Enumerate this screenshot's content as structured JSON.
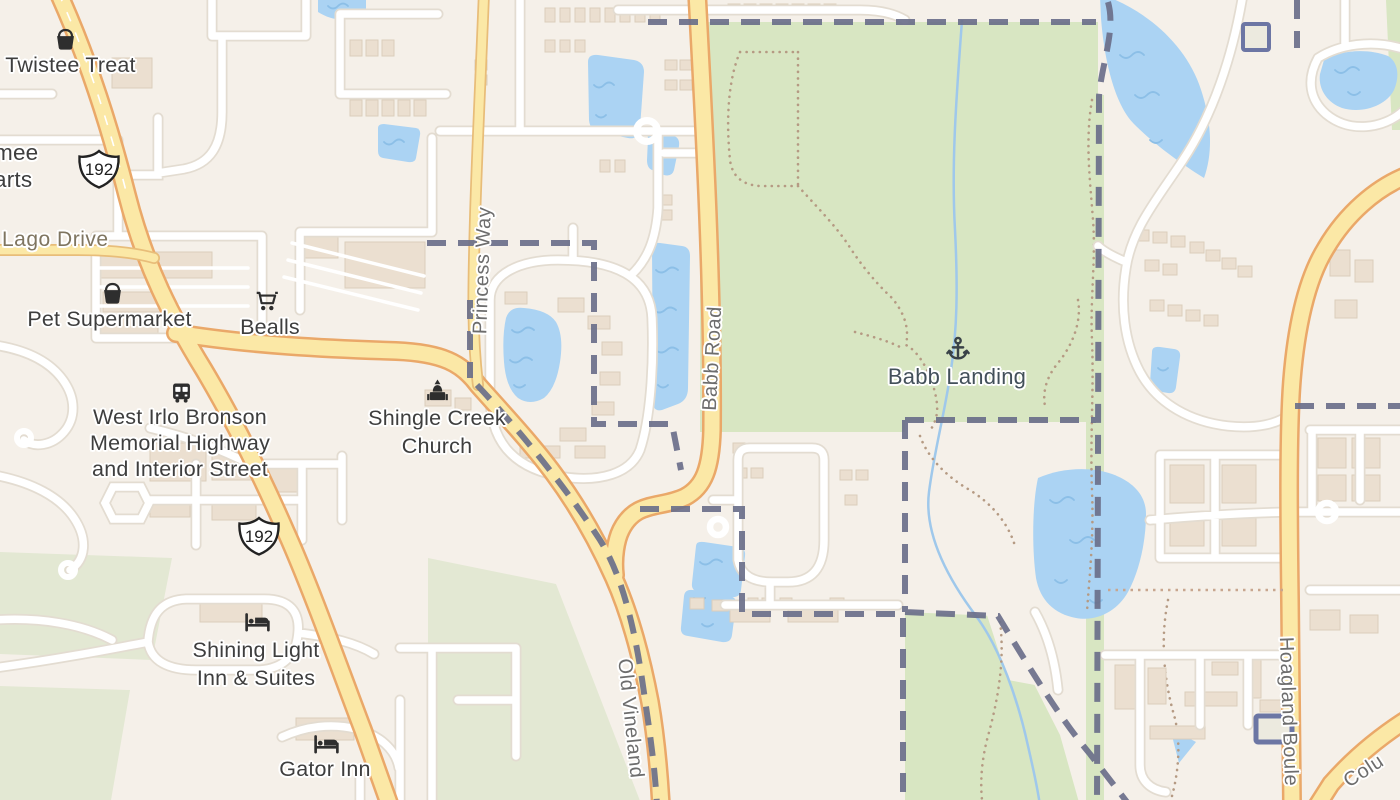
{
  "map": {
    "pois": {
      "twistee_treat": {
        "label": "Twistee Treat",
        "icon": "shopping-basket"
      },
      "kissimmee_partial": {
        "label": "mee\narts"
      },
      "pet_supermarket": {
        "label": "Pet Supermarket",
        "icon": "shopping-basket"
      },
      "bealls": {
        "label": "Bealls",
        "icon": "shopping-cart"
      },
      "west_irlo_bronson": {
        "label": "West Irlo Bronson\nMemorial Highway\nand Interior Street",
        "icon": "bus"
      },
      "shingle_creek_church": {
        "label": "Shingle Creek\nChurch",
        "icon": "church"
      },
      "shining_light_inn": {
        "label": "Shining Light\nInn & Suites",
        "icon": "bed"
      },
      "gator_inn": {
        "label": "Gator Inn",
        "icon": "bed"
      },
      "babb_landing": {
        "label": "Babb Landing",
        "icon": "anchor"
      }
    },
    "road_labels": {
      "lago_drive": "Lago Drive",
      "princess_way": "Princess Way",
      "babb_road": "Babb Road",
      "old_vineland": "Old Vineland",
      "hoagland_boulevard": "Hoagland Boule",
      "columbia_partial": "Colu"
    },
    "shields": {
      "us_192": "192"
    },
    "colors": {
      "background": "#f5f0e9",
      "road_major_fill": "#fbe8a6",
      "road_major_casing": "#eaa869",
      "water": "#abd3f3",
      "park": "#d8e6c2",
      "boundary": "#6a6f8a",
      "poi_label": "#3e3e3e",
      "road_label": "#6d6d6d",
      "park_label": "#43505a"
    }
  }
}
